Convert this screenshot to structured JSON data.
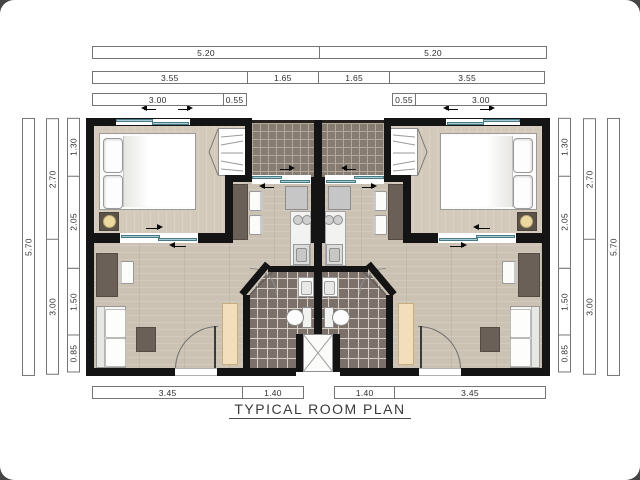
{
  "title": "TYPICAL ROOM PLAN",
  "dims": {
    "top_overall": [
      {
        "label": "5.20",
        "m": 5.2
      },
      {
        "label": "5.20",
        "m": 5.2
      }
    ],
    "top_mid": [
      {
        "label": "3.55",
        "m": 3.55
      },
      {
        "label": "1.65",
        "m": 1.65
      },
      {
        "label": "1.65",
        "m": 1.65
      },
      {
        "label": "3.55",
        "m": 3.55
      }
    ],
    "top_inner_left": [
      {
        "label": "3.00",
        "m": 3.0
      },
      {
        "label": "0.55",
        "m": 0.55
      }
    ],
    "top_inner_right": [
      {
        "label": "0.55",
        "m": 0.55
      },
      {
        "label": "3.00",
        "m": 3.0
      }
    ],
    "side_left_outer": [
      {
        "label": "5.70",
        "m": 5.7
      }
    ],
    "side_left_mid": [
      {
        "label": "2.70",
        "m": 2.7
      },
      {
        "label": "3.00",
        "m": 3.0
      }
    ],
    "side_left_inner": [
      {
        "label": "1.30",
        "m": 1.3
      },
      {
        "label": "2.05",
        "m": 2.05
      },
      {
        "label": "1.50",
        "m": 1.5
      },
      {
        "label": "0.85",
        "m": 0.85
      }
    ],
    "side_right_inner": [
      {
        "label": "1.30",
        "m": 1.3
      },
      {
        "label": "2.05",
        "m": 2.05
      },
      {
        "label": "1.50",
        "m": 1.5
      },
      {
        "label": "0.85",
        "m": 0.85
      }
    ],
    "side_right_mid": [
      {
        "label": "2.70",
        "m": 2.7
      },
      {
        "label": "3.00",
        "m": 3.0
      }
    ],
    "side_right_outer": [
      {
        "label": "5.70",
        "m": 5.7
      }
    ],
    "bottom_left": [
      {
        "label": "3.45",
        "m": 3.45
      },
      {
        "label": "1.40",
        "m": 1.4
      }
    ],
    "bottom_right": [
      {
        "label": "1.40",
        "m": 1.4
      },
      {
        "label": "3.45",
        "m": 3.45
      }
    ]
  },
  "palette": {
    "wall": "#141414",
    "wood_living": "#cbc2b3",
    "wood_bedroom": "#d3cabb",
    "tile_balcony": "#877c72",
    "tile_bathroom": "#7c716a",
    "window_glass": "#a6ccd2",
    "furniture_dark": "#6b6057",
    "cabinet_cream": "#f3debc",
    "lamp": "#ecd9a0"
  }
}
